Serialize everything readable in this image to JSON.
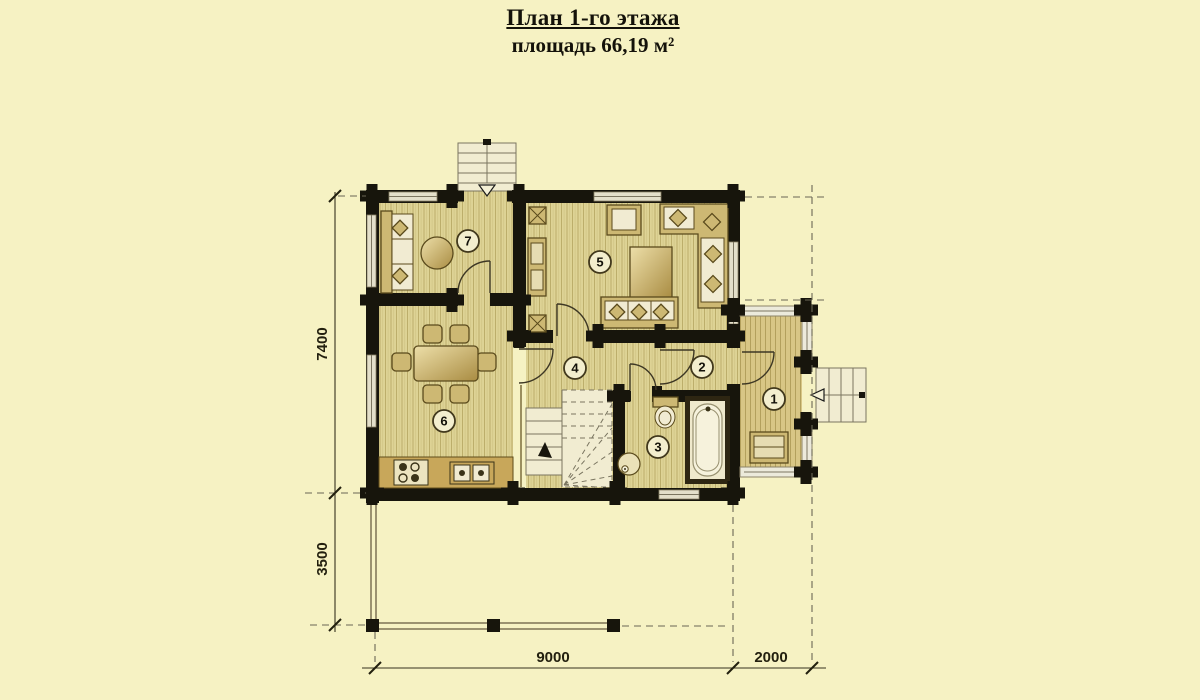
{
  "page": {
    "background_color": "#f6f2c3"
  },
  "header": {
    "title": "План 1-го этажа",
    "subtitle": "площадь 66,19 м²"
  },
  "plan": {
    "rooms": [
      {
        "number": "1"
      },
      {
        "number": "2"
      },
      {
        "number": "3"
      },
      {
        "number": "4"
      },
      {
        "number": "5"
      },
      {
        "number": "6"
      },
      {
        "number": "7"
      }
    ],
    "dimensions": {
      "left_upper": "7400",
      "left_lower": "3500",
      "bottom_left": "9000",
      "bottom_right": "2000"
    },
    "colors": {
      "background": "#f6f2c3",
      "wall": "#17150c",
      "floor": "#ded395",
      "floor_stripe": "#bcae6b",
      "entry_floor": "#d8c685",
      "furniture": "#cdb873",
      "cushion": "#f1ebd2",
      "counter": "#c8a75a",
      "dimension_text": "#23200f"
    }
  }
}
